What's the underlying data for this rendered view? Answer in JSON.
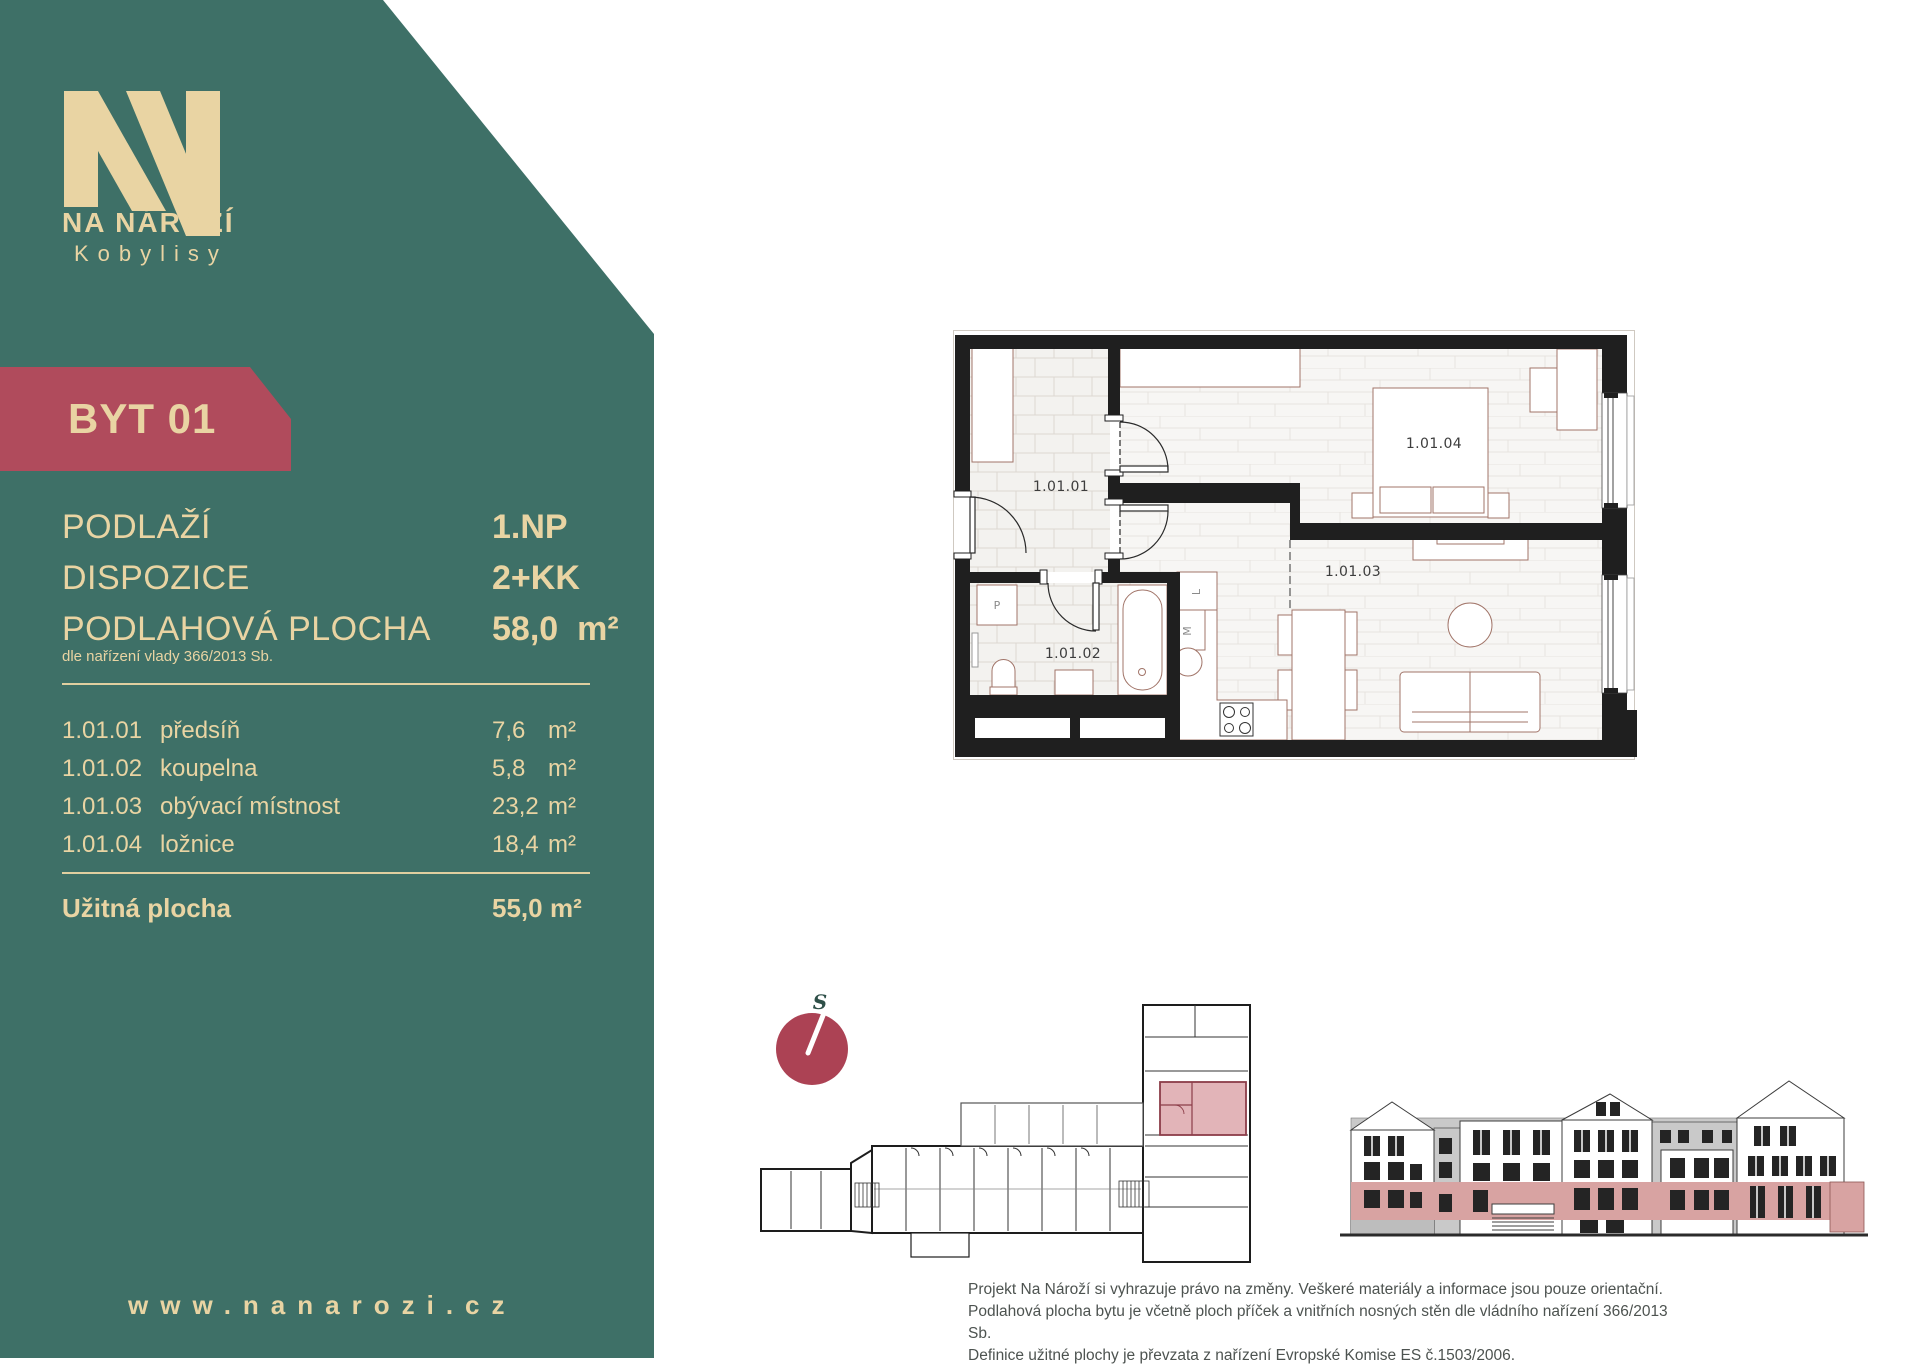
{
  "colors": {
    "teal": "#3E7067",
    "cream": "#E9D4A3",
    "badge_red": "#B04B5C",
    "plan_wall": "#1F1F1F",
    "unit_highlight_pink": "#E2B4B8",
    "elevation_floor_pink": "#D8A3A2",
    "compass_red": "#AC4254"
  },
  "brand": {
    "monogram": "NN",
    "name": "NA NÁROŽÍ",
    "city": "Kobylisy",
    "website": "www.nanarozi.cz"
  },
  "unit_badge": "BYT 01",
  "summary": {
    "floor_label": "PODLAŽÍ",
    "floor_value": "1.NP",
    "layout_label": "DISPOZICE",
    "layout_value": "2+KK",
    "area_label": "PODLAHOVÁ PLOCHA",
    "area_value": "58,0",
    "area_unit": "m²",
    "note": "dle nařízení vlady 366/2013 Sb."
  },
  "rooms": [
    {
      "code": "1.01.01",
      "name": "předsíň",
      "area": "7,6",
      "unit": "m²"
    },
    {
      "code": "1.01.02",
      "name": "koupelna",
      "area": "5,8",
      "unit": "m²"
    },
    {
      "code": "1.01.03",
      "name": "obývací místnost",
      "area": "23,2",
      "unit": "m²"
    },
    {
      "code": "1.01.04",
      "name": "ložnice",
      "area": "18,4",
      "unit": "m²"
    }
  ],
  "total": {
    "label": "Užitná plocha",
    "area": "55,0",
    "unit": "m²"
  },
  "floorplan": {
    "labels": {
      "hall": "1.01.01",
      "bathroom": "1.01.02",
      "living": "1.01.03",
      "bedroom": "1.01.04"
    },
    "fixtures": {
      "washer": "P",
      "pantry": "L",
      "fridge": "M"
    }
  },
  "compass": {
    "north_label": "S"
  },
  "disclaimer": {
    "line1": "Projekt Na Nároží si vyhrazuje právo na změny. Veškeré materiály a informace jsou pouze orientační.",
    "line2": "Podlahová plocha bytu je včetně ploch příček a vnitřních nosných stěn dle vládního nařízení 366/2013 Sb.",
    "line3": "Definice užitné plochy je převzata z nařízení Evropské Komise ES č.1503/2006."
  }
}
